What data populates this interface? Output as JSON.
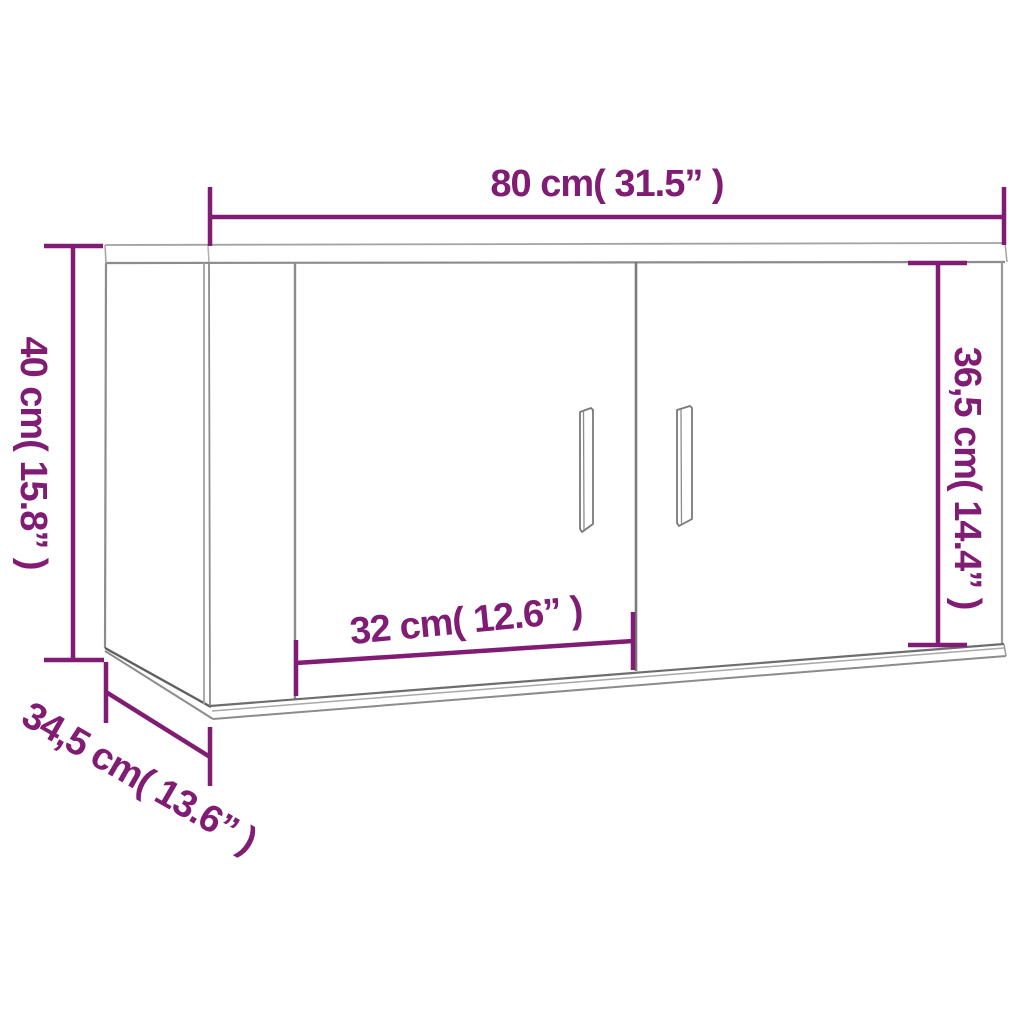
{
  "diagram": {
    "type": "product-dimension-diagram",
    "subject": "wall-mounted-two-door-cabinet",
    "colors": {
      "dimension_accent": "#801c74",
      "outline_gray": "#8c8c8c",
      "background": "#ffffff"
    },
    "dimensions": {
      "width": {
        "label": "80 cm( 31.5” )"
      },
      "height": {
        "label": "40 cm( 15.8” )"
      },
      "inner_height": {
        "label": "36,5 cm( 14.4” )"
      },
      "door_width": {
        "label": "32 cm( 12.6” )"
      },
      "depth": {
        "label": "34,5 cm( 13.6” )"
      }
    }
  }
}
